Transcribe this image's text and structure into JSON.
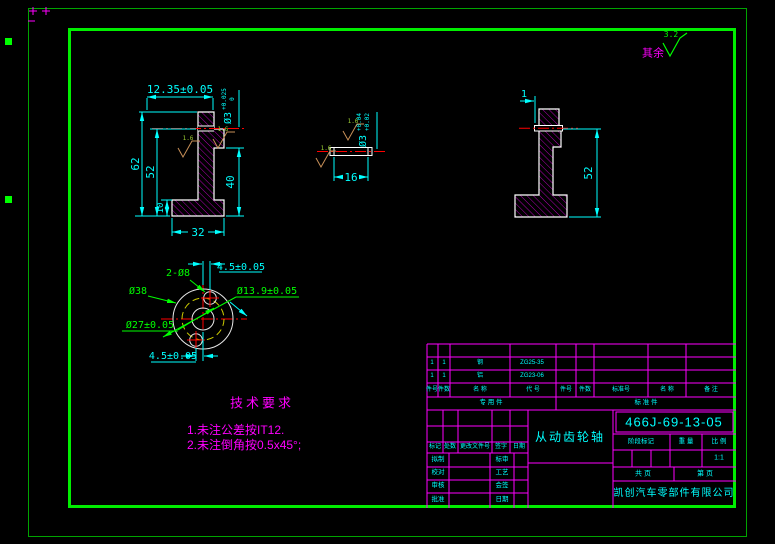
{
  "colors": {
    "background": "#000000",
    "outer_border": "#00a400",
    "inner_border": "#00ee00",
    "grid_magenta": "#ff00ff",
    "text_cyan": "#00ffff",
    "label_green": "#00ff00",
    "centerline_red": "#ff0000",
    "outline_white": "#ffffff",
    "hatch_magenta": "#dd00dd"
  },
  "note": {
    "other_text": "其余",
    "roughness": "3.2"
  },
  "views": {
    "front": {
      "dim_width_top": "12.35±0.05",
      "hole": "Ø3",
      "hole_tol_up": "+0.025",
      "hole_tol_low": "0",
      "dim_62": "62",
      "dim_52": "52",
      "dim_40": "40",
      "dim_10": "10",
      "dim_32": "32",
      "roughness_a": "1.6",
      "roughness_b": "1.6"
    },
    "detail": {
      "dim_16": "16",
      "hole": "Ø3",
      "tol_up": "+0.04",
      "tol_low": "+0.02",
      "roughness_a": "1.6",
      "roughness_b": "1.6"
    },
    "side": {
      "dim_1": "1",
      "dim_52": "52"
    },
    "end": {
      "holes": "2-Ø8",
      "outer": "Ø38",
      "bolt_circle": "Ø27±0.05",
      "bore": "Ø13.9±0.05",
      "offset_top": "4.5±0.05",
      "offset_bottom": "4.5±0.05"
    }
  },
  "tech": {
    "title": "技术要求",
    "line1": "1.未注公差按IT12.",
    "line2": "2.未注倒角按0.5x45°;"
  },
  "tb": {
    "parts": {
      "hl": [
        "件号",
        "件数",
        "名  称",
        "代  号"
      ],
      "hr": [
        "件号",
        "件数",
        "标准号",
        "名  称",
        "备 注"
      ],
      "r1": [
        "1",
        "1",
        "钢",
        "ZG25-35"
      ],
      "r2": [
        "1",
        "1",
        "铝",
        "ZG23-06"
      ],
      "group_left": "专  用  件",
      "group_right": "标  准  件"
    },
    "rev": [
      "标记",
      "处数",
      "更改文件号",
      "签字",
      "日期"
    ],
    "sig": [
      [
        "拟制",
        "标审"
      ],
      [
        "校对",
        "工艺"
      ],
      [
        "审核",
        "会签"
      ],
      [
        "批准",
        "日期"
      ]
    ],
    "part_name": "从动齿轮轴",
    "dwg_no": "466J-69-13-05",
    "stage": "阶段标记",
    "weight": "重 量",
    "scale": "比 例",
    "scale_value": "1:1",
    "sheet_total": "共   页",
    "sheet_no": "第   页",
    "company": "凯创汽车零部件有限公司"
  }
}
